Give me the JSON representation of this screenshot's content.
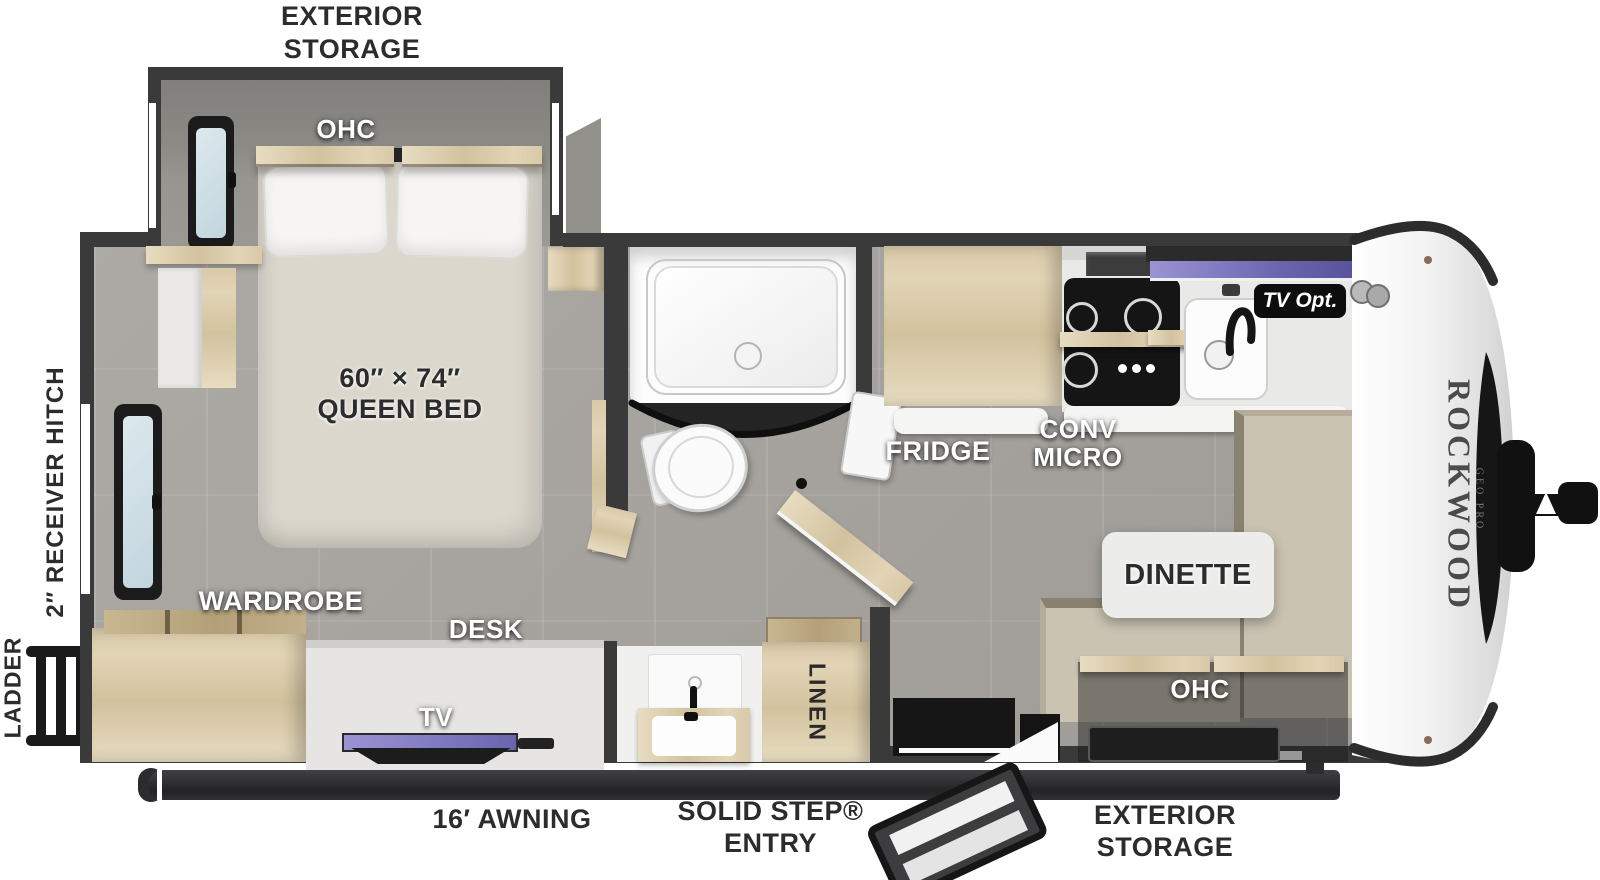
{
  "meta": {
    "title": "Rockwood Geo Pro travel trailer floorplan"
  },
  "exterior": {
    "storage_top": [
      "EXTERIOR",
      "STORAGE"
    ],
    "storage_bottom": [
      "EXTERIOR",
      "STORAGE"
    ],
    "awning": "16′ AWNING",
    "entry": [
      "SOLID STEP®",
      "ENTRY"
    ],
    "receiver_hitch": "2″ RECEIVER HITCH",
    "ladder": "LADDER"
  },
  "bedroom": {
    "ohc": "OHC",
    "bed_size": "60″ × 74″",
    "bed_type": "QUEEN BED",
    "wardrobe": "WARDROBE"
  },
  "living": {
    "desk": "DESK",
    "tv": "TV",
    "dinette": "DINETTE",
    "ohc": "OHC",
    "linen": "LINEN"
  },
  "kitchen": {
    "fridge": "FRIDGE",
    "conv_micro": [
      "CONV",
      "MICRO"
    ],
    "tv_opt": "TV Opt."
  },
  "brand": {
    "name": "ROCKWOOD",
    "sub": "GEO PRO"
  },
  "colors": {
    "wall": "#3a3a3a",
    "floor": "#a8a5a0",
    "wood": "#d9cbab",
    "bench": "#cac3b2",
    "bed": "#dbd7cd",
    "tv_accent": "#8b85c6",
    "label_dark": "#2c2c2c",
    "label_light": "#ffffff",
    "awning": "#2a2a2c"
  }
}
